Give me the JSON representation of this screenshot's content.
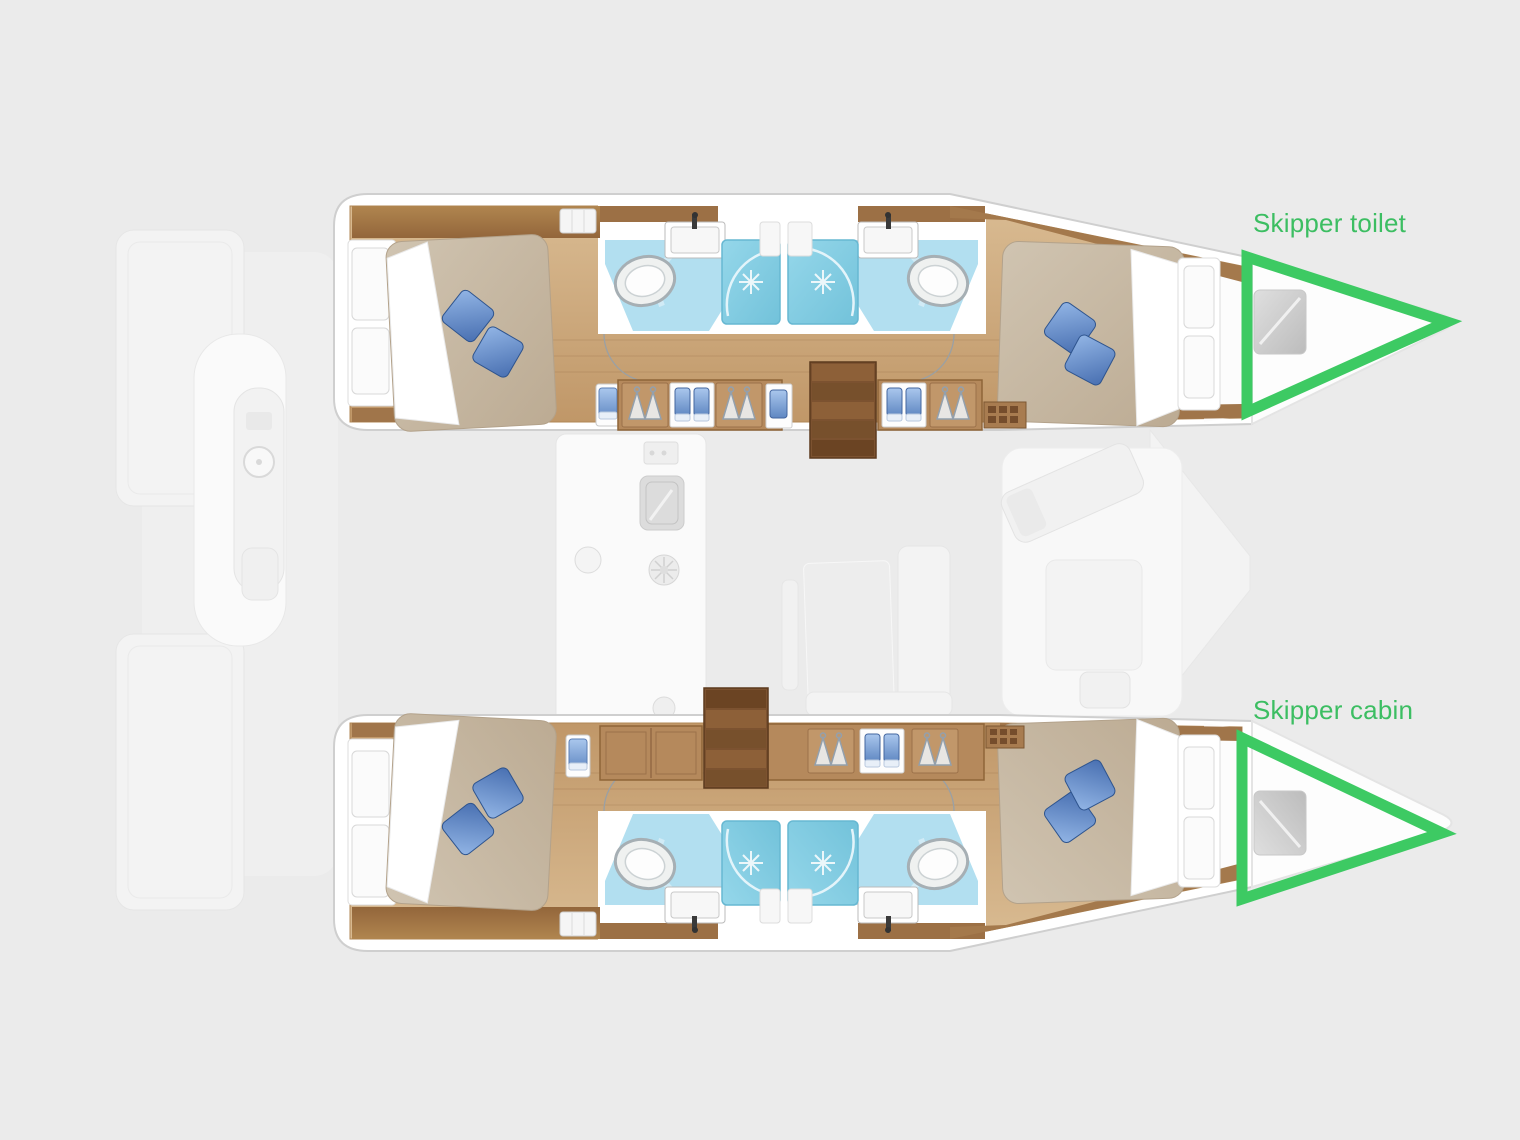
{
  "canvas": {
    "width": 1520,
    "height": 1140,
    "background": "#EBEBEB"
  },
  "diagram_type": "catamaran-floor-plan",
  "annotations": [
    {
      "id": "skipper-toilet",
      "label": "Skipper toilet",
      "shape": "triangle-outline",
      "location": "top-hull-bow"
    },
    {
      "id": "skipper-cabin",
      "label": "Skipper cabin",
      "shape": "triangle-outline",
      "location": "bottom-hull-bow"
    }
  ],
  "colors": {
    "annotation_green": "#3DCA63",
    "annotation_text": "#3CBE62",
    "background": "#EBEBEB",
    "hull_white": "#FFFFFF",
    "wood_floor": "#C9A276",
    "wood_trim_dark": "#A4794C",
    "bathroom_blue": "#B2DFF0",
    "shower_blue": "#82CDE3",
    "mattress_beige": "#C8BAA6",
    "pillow_blue": "#5B84C6",
    "faded_deck_gray": "#F2F2F2"
  }
}
